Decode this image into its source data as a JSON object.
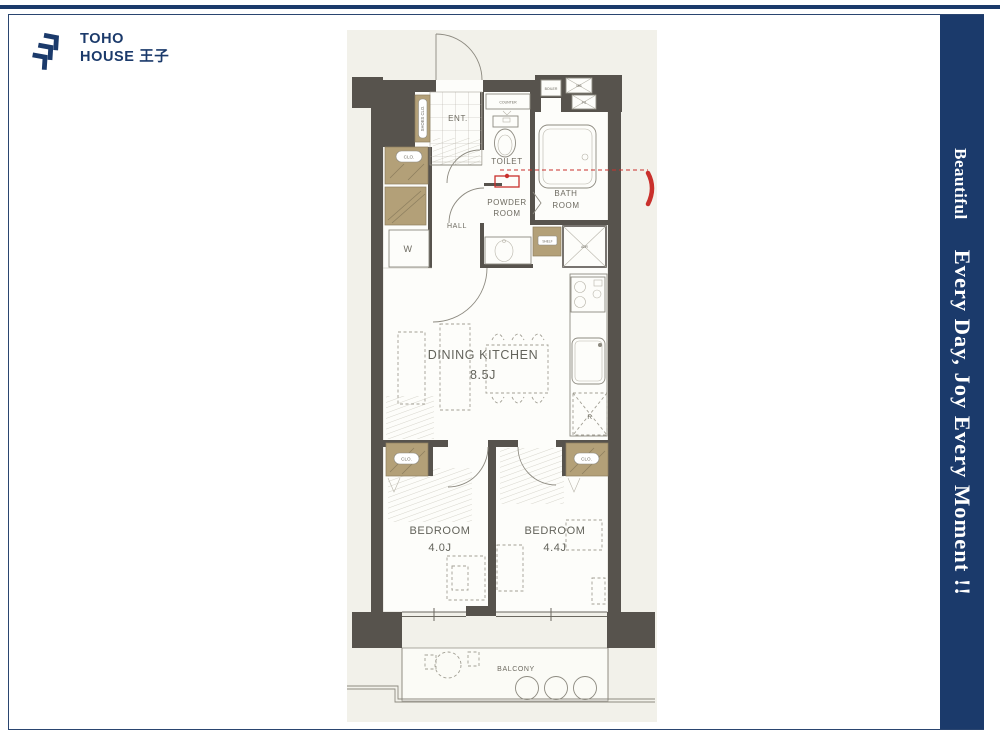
{
  "header": {
    "logo_line1": "TOHO",
    "logo_line2": "HOUSE 王子"
  },
  "banner": {
    "text_small": "Beautiful",
    "text_large": "Every Day, Joy Every Moment !!"
  },
  "floorplan": {
    "rooms": {
      "ent": "ENT.",
      "hall": "HALL",
      "toilet": "TOILET",
      "powder_line1": "POWDER",
      "powder_line2": "ROOM",
      "bath_line1": "BATH",
      "bath_line2": "ROOM",
      "dining": "DINING KITCHEN",
      "dining_size": "8.5J",
      "bedroom1": "BEDROOM",
      "bedroom1_size": "4.0J",
      "bedroom2": "BEDROOM",
      "bedroom2_size": "4.4J",
      "balcony": "BALCONY"
    },
    "fixtures": {
      "shoes_closet": "SHOES CLO.",
      "closet": "CLO.",
      "counter": "COUNTER",
      "boiler": "BOILER",
      "meter_box": "MB",
      "pipe_space": "PS",
      "adr": "ADR",
      "shelf": "SHELF",
      "washer": "W",
      "refrigerator": "R"
    },
    "colors": {
      "wall": "#57534d",
      "closet": "#b3a078",
      "plan_background": "#f2f1ea",
      "accent_red": "#c9302c",
      "navy": "#1b3a6b"
    }
  }
}
